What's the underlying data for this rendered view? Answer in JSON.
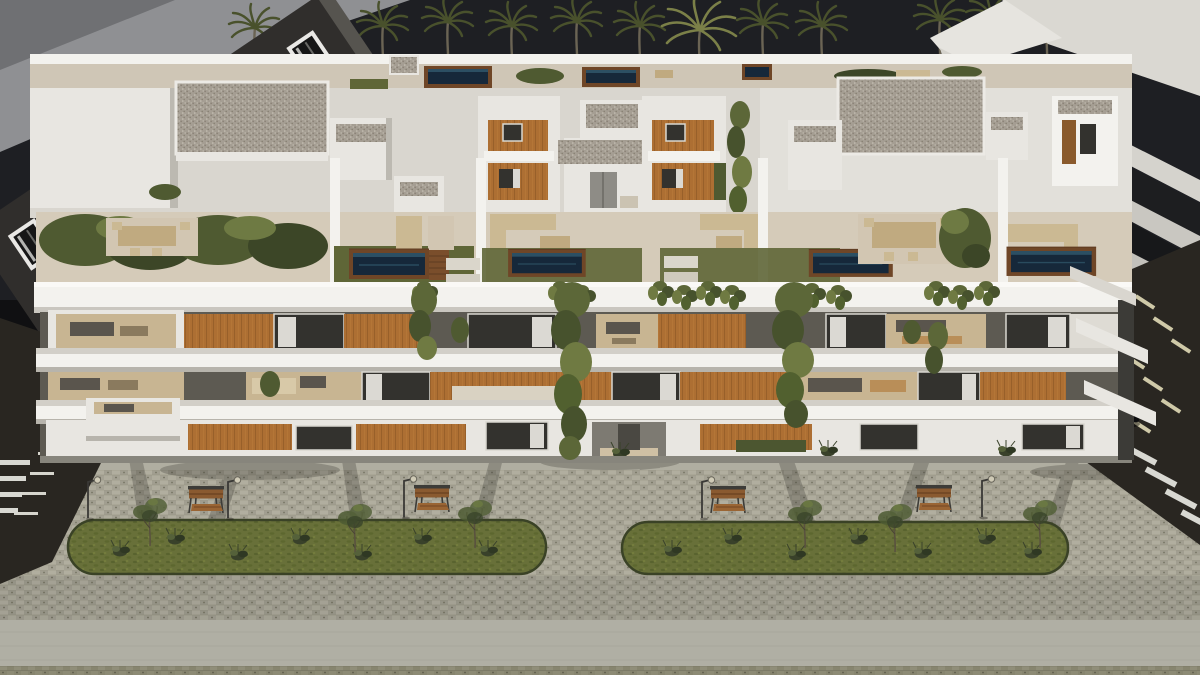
{
  "scene": {
    "title": "aerial-dusk-render-apartment-complex",
    "time_of_day": "dusk",
    "counts": {
      "palm_trees": 13,
      "rooftop_terrace_pools": 5,
      "rear_roof_pools": 3,
      "facade_floors": 3,
      "median_strips": 2,
      "benches": 4,
      "street_lamps": 5,
      "median_trees": 6,
      "roads": 2,
      "scooters": 1
    }
  },
  "colors": {
    "sky": "#1e1f23",
    "backdrop_wedge": "#8f9093",
    "backdrop_wedge_dark": "#6f7073",
    "neighbor_dark_facade": "#302e2c",
    "neighbor_glass": "#1d1e20",
    "white_bright": "#f3f2ee",
    "white_mid": "#e8e6e1",
    "white_dim": "#d9d6cf",
    "gravel": "#a59e93",
    "wood_cladding": "#ad6f33",
    "glass_dark": "#33322e",
    "curtain": "#e9e7e2",
    "interior_beige": "#c8b592",
    "terrace_deck": "#d5cbb9",
    "grass_roof": "#5f6637",
    "grass_median": "#687039",
    "hedge": "#4f5a31",
    "pool_water": "#16283a",
    "pool_rim_wood": "#6f4627",
    "plaza_paver": "#a9a79a",
    "plaza_light": "#b0afa4",
    "forecourt": "#b0aea1",
    "asphalt": "#292621",
    "road_marking": "#d6d5cd",
    "bench_wood": "#8a5a30",
    "metal_dark": "#3d3c38"
  }
}
